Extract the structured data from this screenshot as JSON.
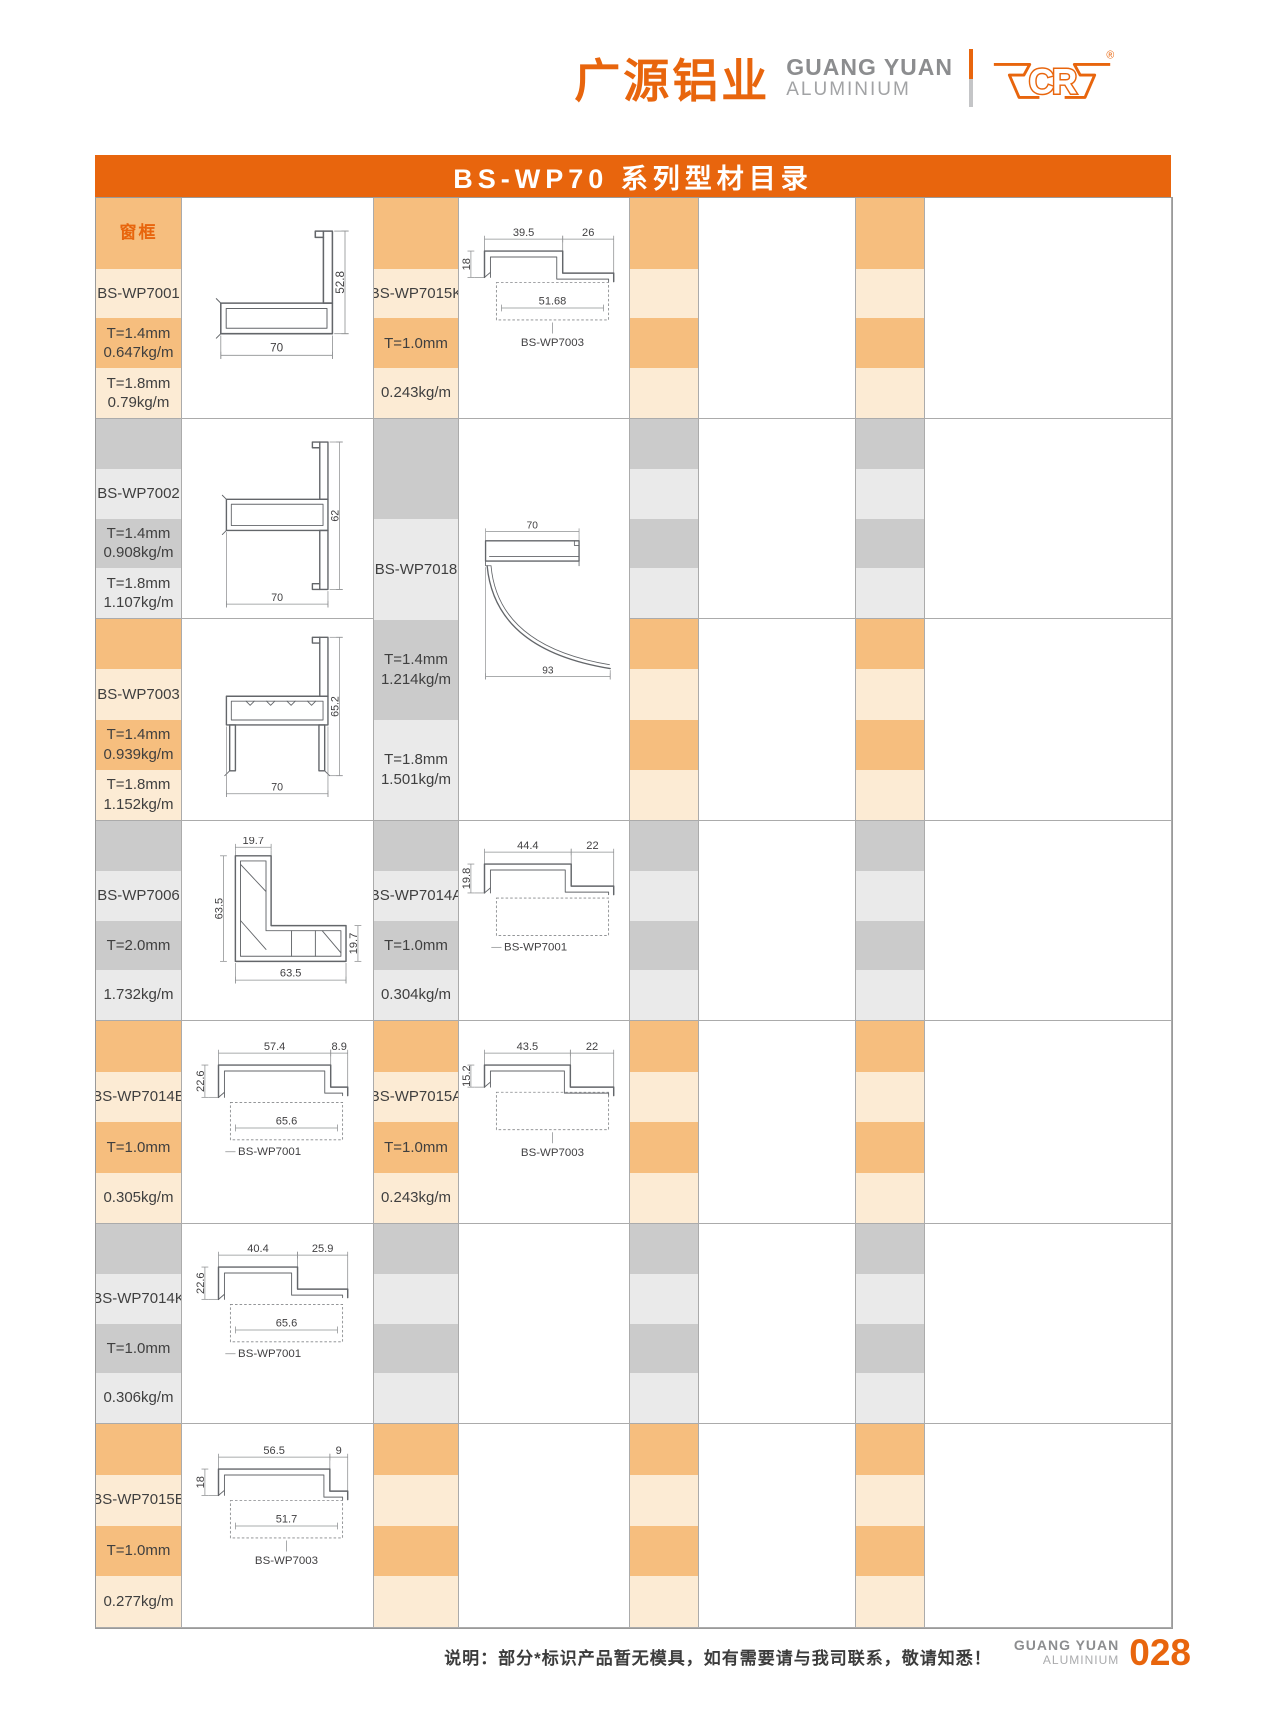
{
  "brand": {
    "cn": "广源铝业",
    "en_line1": "GUANG YUAN",
    "en_line2": "ALUMINIUM",
    "logo_text": "CR",
    "registered": "®"
  },
  "title": "BS-WP70 系列型材目录",
  "category_label": "窗框",
  "footer": {
    "note": "说明：部分*标识产品暂无模具，如有需要请与我司联系，敬请知悉！",
    "brand_line1": "GUANG YUAN",
    "brand_line2": "ALUMINIUM",
    "page_number": "028"
  },
  "colors": {
    "accent": "#e8650d",
    "band_orange_dark": "#f6be7e",
    "band_orange_light": "#fcebd4",
    "band_gray_dark": "#cbcbcb",
    "band_gray_light": "#eaeaea",
    "grid_line": "#ababab"
  },
  "table": {
    "col_widths": [
      86,
      192,
      85,
      171,
      69,
      157,
      69,
      247
    ],
    "row_heights": [
      221,
      200,
      202,
      200,
      203,
      200,
      204
    ],
    "cells": [
      {
        "col": 1,
        "row": 1,
        "kind": "bands",
        "theme": "orange",
        "first_tall": true,
        "cat": true,
        "code": "BS-WP7001",
        "bands": [
          [
            "窗框"
          ],
          [
            "BS-WP7001"
          ],
          [
            "T=1.4mm",
            "0.647kg/m"
          ],
          [
            "T=1.8mm",
            "0.79kg/m"
          ]
        ]
      },
      {
        "col": 2,
        "row": 1,
        "kind": "drawing",
        "code": "BS-WP7001",
        "dtype": "flange-tube",
        "dims": {
          "bottom": "70",
          "right": "52.8"
        }
      },
      {
        "col": 3,
        "row": 1,
        "kind": "bands",
        "theme": "orange",
        "first_tall": true,
        "code": "BS-WP7015K",
        "bands": [
          [],
          [
            "BS-WP7015K"
          ],
          [
            "T=1.0mm"
          ],
          [
            "0.243kg/m"
          ]
        ]
      },
      {
        "col": 4,
        "row": 1,
        "kind": "drawing",
        "code": "BS-WP7015K",
        "dtype": "hat",
        "leader": "v",
        "companion": "BS-WP7003",
        "dims": {
          "top1": "39.5",
          "top2": "26",
          "left": "18",
          "inner": "51.68"
        }
      },
      {
        "col": 5,
        "row": 1,
        "kind": "bands",
        "theme": "orange",
        "first_tall": true,
        "bands": [
          [],
          [],
          [],
          []
        ]
      },
      {
        "col": 6,
        "row": 1,
        "kind": "empty"
      },
      {
        "col": 7,
        "row": 1,
        "kind": "bands",
        "theme": "orange",
        "first_tall": true,
        "bands": [
          [],
          [],
          [],
          []
        ]
      },
      {
        "col": 8,
        "row": 1,
        "kind": "empty"
      },
      {
        "col": 1,
        "row": 2,
        "kind": "bands",
        "theme": "gray",
        "code": "BS-WP7002",
        "bands": [
          [],
          [
            "BS-WP7002"
          ],
          [
            "T=1.4mm",
            "0.908kg/m"
          ],
          [
            "T=1.8mm",
            "1.107kg/m"
          ]
        ]
      },
      {
        "col": 2,
        "row": 2,
        "kind": "drawing",
        "code": "BS-WP7002",
        "dtype": "double-flange-tube",
        "dims": {
          "bottom": "70",
          "right": "62"
        }
      },
      {
        "col": 3,
        "row": 2,
        "rowspan": 2,
        "kind": "bands",
        "theme": "gray",
        "code": "BS-WP7018",
        "bands": [
          [],
          [
            "BS-WP7018"
          ],
          [
            "T=1.4mm",
            "1.214kg/m"
          ],
          [
            "T=1.8mm",
            "1.501kg/m"
          ]
        ]
      },
      {
        "col": 4,
        "row": 2,
        "rowspan": 2,
        "kind": "drawing",
        "code": "BS-WP7018",
        "dtype": "quarter",
        "dims": {
          "top": "70",
          "bottom": "93"
        }
      },
      {
        "col": 5,
        "row": 2,
        "kind": "bands",
        "theme": "gray",
        "bands": [
          [],
          [],
          [],
          []
        ]
      },
      {
        "col": 6,
        "row": 2,
        "kind": "empty"
      },
      {
        "col": 7,
        "row": 2,
        "kind": "bands",
        "theme": "gray",
        "bands": [
          [],
          [],
          [],
          []
        ]
      },
      {
        "col": 8,
        "row": 2,
        "kind": "empty"
      },
      {
        "col": 1,
        "row": 3,
        "kind": "bands",
        "theme": "orange",
        "code": "BS-WP7003",
        "bands": [
          [],
          [
            "BS-WP7003"
          ],
          [
            "T=1.4mm",
            "0.939kg/m"
          ],
          [
            "T=1.8mm",
            "1.152kg/m"
          ]
        ]
      },
      {
        "col": 2,
        "row": 3,
        "kind": "drawing",
        "code": "BS-WP7003",
        "dtype": "flange-channel",
        "dims": {
          "bottom": "70",
          "right": "65.2"
        }
      },
      {
        "col": 5,
        "row": 3,
        "kind": "bands",
        "theme": "orange",
        "bands": [
          [],
          [],
          [],
          []
        ]
      },
      {
        "col": 6,
        "row": 3,
        "kind": "empty"
      },
      {
        "col": 7,
        "row": 3,
        "kind": "bands",
        "theme": "orange",
        "bands": [
          [],
          [],
          [],
          []
        ]
      },
      {
        "col": 8,
        "row": 3,
        "kind": "empty"
      },
      {
        "col": 1,
        "row": 4,
        "kind": "bands",
        "theme": "gray",
        "code": "BS-WP7006",
        "bands": [
          [],
          [
            "BS-WP7006"
          ],
          [
            "T=2.0mm"
          ],
          [
            "1.732kg/m"
          ]
        ]
      },
      {
        "col": 2,
        "row": 4,
        "kind": "drawing",
        "code": "BS-WP7006",
        "dtype": "corner",
        "dims": {
          "top": "19.7",
          "left": "63.5",
          "bottom": "63.5",
          "right": "19.7"
        }
      },
      {
        "col": 3,
        "row": 4,
        "kind": "bands",
        "theme": "gray",
        "code": "BS-WP7014A",
        "bands": [
          [],
          [
            "BS-WP7014A"
          ],
          [
            "T=1.0mm"
          ],
          [
            "0.304kg/m"
          ]
        ]
      },
      {
        "col": 4,
        "row": 4,
        "kind": "drawing",
        "code": "BS-WP7014A",
        "dtype": "hat",
        "leader": "h",
        "companion": "BS-WP7001",
        "dims": {
          "top1": "44.4",
          "top2": "22",
          "left": "19.8"
        }
      },
      {
        "col": 5,
        "row": 4,
        "kind": "bands",
        "theme": "gray",
        "bands": [
          [],
          [],
          [],
          []
        ]
      },
      {
        "col": 6,
        "row": 4,
        "kind": "empty"
      },
      {
        "col": 7,
        "row": 4,
        "kind": "bands",
        "theme": "gray",
        "bands": [
          [],
          [],
          [],
          []
        ]
      },
      {
        "col": 8,
        "row": 4,
        "kind": "empty"
      },
      {
        "col": 1,
        "row": 5,
        "kind": "bands",
        "theme": "orange",
        "code": "BS-WP7014B",
        "bands": [
          [],
          [
            "BS-WP7014B"
          ],
          [
            "T=1.0mm"
          ],
          [
            "0.305kg/m"
          ]
        ]
      },
      {
        "col": 2,
        "row": 5,
        "kind": "drawing",
        "code": "BS-WP7014B",
        "dtype": "hat",
        "leader": "h",
        "companion": "BS-WP7001",
        "dims": {
          "top1": "57.4",
          "top2": "8.9",
          "left": "22.6",
          "inner": "65.6"
        }
      },
      {
        "col": 3,
        "row": 5,
        "kind": "bands",
        "theme": "orange",
        "code": "BS-WP7015A",
        "bands": [
          [],
          [
            "BS-WP7015A"
          ],
          [
            "T=1.0mm"
          ],
          [
            "0.243kg/m"
          ]
        ]
      },
      {
        "col": 4,
        "row": 5,
        "kind": "drawing",
        "code": "BS-WP7015A",
        "dtype": "hat",
        "leader": "v",
        "companion": "BS-WP7003",
        "dims": {
          "top1": "43.5",
          "top2": "22",
          "left": "15.2"
        }
      },
      {
        "col": 5,
        "row": 5,
        "kind": "bands",
        "theme": "orange",
        "bands": [
          [],
          [],
          [],
          []
        ]
      },
      {
        "col": 6,
        "row": 5,
        "kind": "empty"
      },
      {
        "col": 7,
        "row": 5,
        "kind": "bands",
        "theme": "orange",
        "bands": [
          [],
          [],
          [],
          []
        ]
      },
      {
        "col": 8,
        "row": 5,
        "kind": "empty"
      },
      {
        "col": 1,
        "row": 6,
        "kind": "bands",
        "theme": "gray",
        "code": "BS-WP7014K",
        "bands": [
          [],
          [
            "BS-WP7014K"
          ],
          [
            "T=1.0mm"
          ],
          [
            "0.306kg/m"
          ]
        ]
      },
      {
        "col": 2,
        "row": 6,
        "kind": "drawing",
        "code": "BS-WP7014K",
        "dtype": "hat",
        "leader": "h",
        "companion": "BS-WP7001",
        "dims": {
          "top1": "40.4",
          "top2": "25.9",
          "left": "22.6",
          "inner": "65.6"
        }
      },
      {
        "col": 3,
        "row": 6,
        "kind": "bands",
        "theme": "gray",
        "bands": [
          [],
          [],
          [],
          []
        ]
      },
      {
        "col": 4,
        "row": 6,
        "kind": "empty"
      },
      {
        "col": 5,
        "row": 6,
        "kind": "bands",
        "theme": "gray",
        "bands": [
          [],
          [],
          [],
          []
        ]
      },
      {
        "col": 6,
        "row": 6,
        "kind": "empty"
      },
      {
        "col": 7,
        "row": 6,
        "kind": "bands",
        "theme": "gray",
        "bands": [
          [],
          [],
          [],
          []
        ]
      },
      {
        "col": 8,
        "row": 6,
        "kind": "empty"
      },
      {
        "col": 1,
        "row": 7,
        "kind": "bands",
        "theme": "orange",
        "code": "BS-WP7015B",
        "bands": [
          [],
          [
            "BS-WP7015B"
          ],
          [
            "T=1.0mm"
          ],
          [
            "0.277kg/m"
          ]
        ]
      },
      {
        "col": 2,
        "row": 7,
        "kind": "drawing",
        "code": "BS-WP7015B",
        "dtype": "hat",
        "leader": "v",
        "companion": "BS-WP7003",
        "dims": {
          "top1": "56.5",
          "top2": "9",
          "left": "18",
          "inner": "51.7"
        }
      },
      {
        "col": 3,
        "row": 7,
        "kind": "bands",
        "theme": "orange",
        "bands": [
          [],
          [],
          [],
          []
        ]
      },
      {
        "col": 4,
        "row": 7,
        "kind": "empty"
      },
      {
        "col": 5,
        "row": 7,
        "kind": "bands",
        "theme": "orange",
        "bands": [
          [],
          [],
          [],
          []
        ]
      },
      {
        "col": 6,
        "row": 7,
        "kind": "empty"
      },
      {
        "col": 7,
        "row": 7,
        "kind": "bands",
        "theme": "orange",
        "bands": [
          [],
          [],
          [],
          []
        ]
      },
      {
        "col": 8,
        "row": 7,
        "kind": "empty"
      }
    ]
  }
}
